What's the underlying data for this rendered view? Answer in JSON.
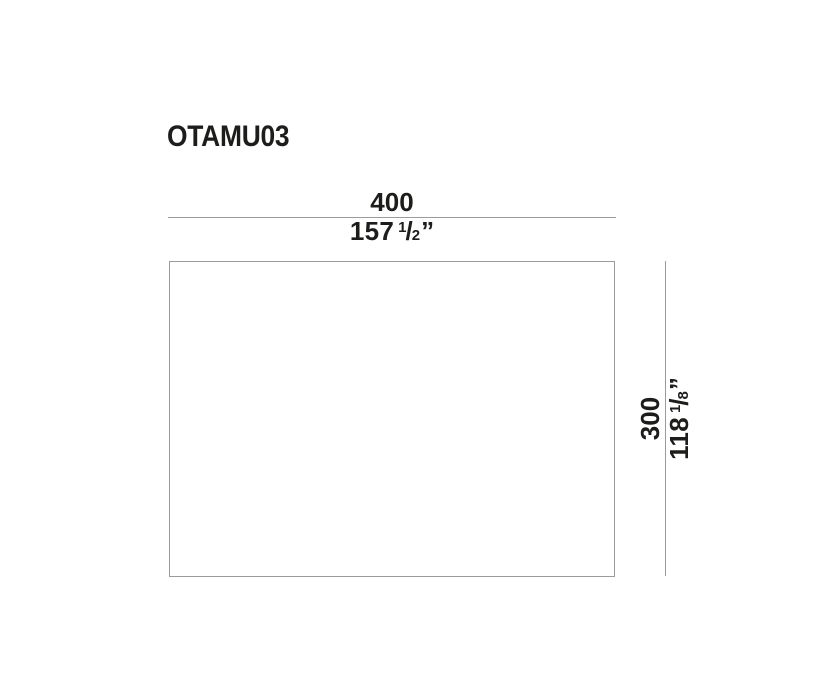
{
  "diagram": {
    "product_code": "OTAMU03",
    "fraction_slash": "/",
    "width": {
      "metric": "400",
      "imperial_whole": "157",
      "imperial_numerator": "1",
      "imperial_denominator": "2",
      "unit": "”"
    },
    "height": {
      "metric": "300",
      "imperial_whole": "118",
      "imperial_numerator": "1",
      "imperial_denominator": "8",
      "unit": "”"
    },
    "colors": {
      "text": "#1d1d1b",
      "line": "#9b9b9b",
      "background": "#ffffff"
    }
  }
}
